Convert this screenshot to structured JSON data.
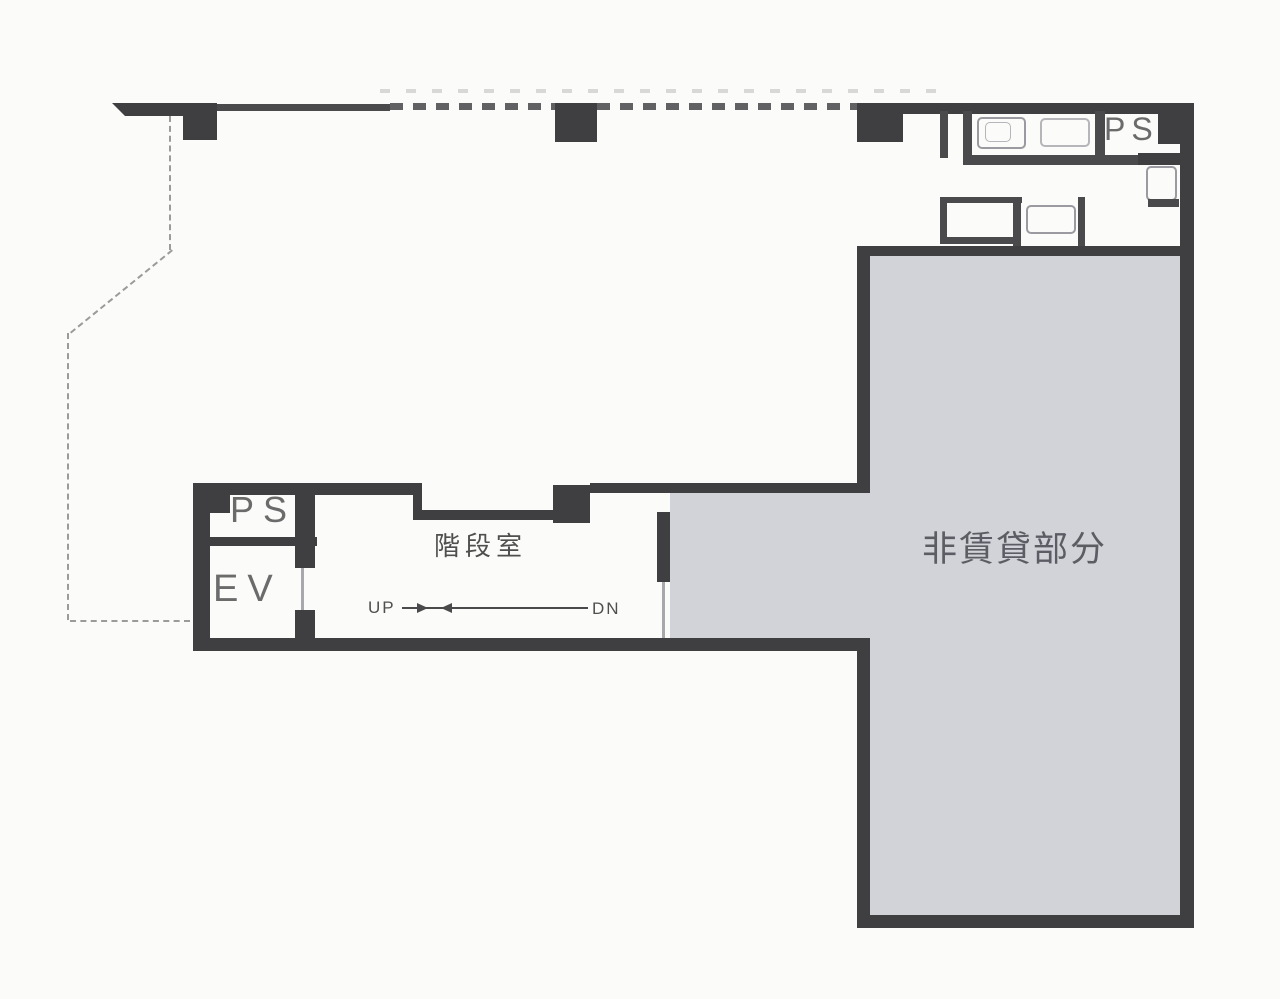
{
  "plan": {
    "title": "building-floor-plan",
    "labels": {
      "ps_top_right": "PS",
      "ps_left": "PS",
      "elevator": "EV",
      "stairwell": "階段室",
      "up": "UP",
      "down": "DN",
      "non_rental": "非賃貸部分"
    },
    "colors": {
      "wall": "#3f3f41",
      "wall_thin": "#4a4a4c",
      "non_rental_fill": "#d2d3d8",
      "fixture_outline": "#9a9aa0",
      "boundary_dash": "#9b9b9b",
      "text_dark": "#4f4f4f",
      "text_mid": "#5c5c64",
      "text_light": "#6b6b6b",
      "background": "#fbfbf9"
    }
  }
}
